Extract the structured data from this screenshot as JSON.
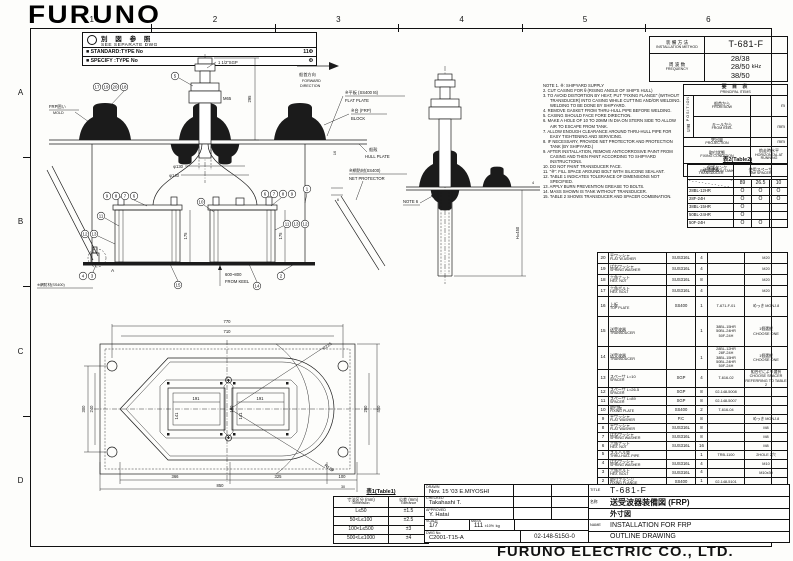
{
  "logo": "FURUNO",
  "company": "FURUNO ELECTRIC CO., LTD.",
  "grid": {
    "cols": [
      "1",
      "2",
      "3",
      "4",
      "5",
      "6"
    ],
    "rows": [
      "A",
      "B",
      "C",
      "D"
    ]
  },
  "ref_box": {
    "jp": "別 図 参 照",
    "en": "SEE SEPARATE DWG",
    "standard_label": "■ STANDARD:TYPE No",
    "standard_value": "11Φ",
    "specify_label": "■ SPECIFY :TYPE No",
    "specify_value": "Φ"
  },
  "method_table": {
    "method_jp": "装 備 方 法",
    "method_en": "INSTALLATION METHOD",
    "method_value": "T-681-F",
    "freq_jp": "周 波 数",
    "freq_en": "FREQUENCY",
    "freq_values": [
      "28/38",
      "28/50",
      "38/50"
    ],
    "freq_unit": "kHz"
  },
  "principal": {
    "title_jp": "要 目 表",
    "title_en": "PRINCIPAL ITEMS",
    "position_jp": "位置",
    "position_en": "POSITION",
    "row_bow_jp": "船首から",
    "row_bow_en": "FROM BOW",
    "row_bow_unit": "m",
    "row_keel_jp": "キールから",
    "row_keel_en": "FROM KEEL",
    "row_keel_unit": "mm",
    "row_proj_jp": "突出量",
    "row_proj_en": "PROJECTION",
    "row_proj_unit": "mm",
    "row_fix_jp": "取付状態",
    "row_fix_en": "FIXING CONDITION",
    "row_fix_val_jp": "航走時水平",
    "row_fix_val_en": "HORIZONTAL AT RUNNING",
    "row_tank_jp": "保護タンク",
    "row_tank_en": "PROTECTION TANK",
    "row_tank_val": ""
  },
  "table2": {
    "title": "表2(Table2)",
    "transducer_jp": "送受波器",
    "transducer_en": "TRANSDUCER",
    "spacer_jp": "使用スペーサ",
    "spacer_en": "Use SPACER",
    "spacer_cols": [
      "89",
      "26.5",
      "10"
    ],
    "rows": [
      {
        "model": "28BL-12HR",
        "marks": [
          "O",
          "O",
          "O"
        ]
      },
      {
        "model": "28F-24H",
        "marks": [
          "O",
          "O",
          "O"
        ]
      },
      {
        "model": "38BL-15HR",
        "marks": [
          "O",
          "",
          ""
        ]
      },
      {
        "model": "50BL-24HR",
        "marks": [
          "O",
          "",
          ""
        ]
      },
      {
        "model": "50F-24H",
        "marks": [
          "O",
          "O",
          ""
        ]
      }
    ]
  },
  "parts": {
    "header": {
      "no_jp": "番号",
      "name_jp": "名 称",
      "name_en": "NAME",
      "material_jp": "材 質",
      "material_en": "MATERIAL",
      "qty_jp": "数量",
      "qty_en": "Q'TY",
      "dwg_jp": "図 番",
      "dwg_en": "DWG.NO.",
      "remarks_jp": "摘 要",
      "remarks_en": "REMARKS"
    },
    "rows": [
      {
        "no": "20",
        "name_jp": "平ワッシャ",
        "name_en": "FLAT W ASHER",
        "material": "SUS316L",
        "qty": "4",
        "dwg": "",
        "remarks": "M20"
      },
      {
        "no": "19",
        "name_jp": "ばねワッシャ",
        "name_en": "SPRING WASHER",
        "material": "SUS316L",
        "qty": "4",
        "dwg": "",
        "remarks": "M20"
      },
      {
        "no": "18",
        "name_jp": "六角ナット",
        "name_en": "HEX. NUT",
        "material": "SUS316L",
        "qty": "8",
        "dwg": "",
        "remarks": "M20"
      },
      {
        "no": "17",
        "name_jp": "六角ボルト",
        "name_en": "HEX. BOLT",
        "material": "SUS316L",
        "qty": "4",
        "dwg": "",
        "remarks": "M20"
      },
      {
        "no": "16",
        "name_jp": "上板",
        "name_en": "TOP PLATE",
        "material": "SS400",
        "qty": "1",
        "dwg": "T-671-F-01",
        "remarks": "めっき MONJ.8"
      },
      {
        "no": "15",
        "name_jp": "送受波器",
        "name_en": "TRANSDUCER",
        "material": "",
        "qty": "1",
        "dwg": "38BL-15HR\n50BL-24HR\n50F-24H",
        "remarks": "1個選択\nCHOOSE ONE"
      },
      {
        "no": "14",
        "name_jp": "送受波器",
        "name_en": "TRANSDUCER",
        "material": "",
        "qty": "1",
        "dwg": "28BL-12HR\n28F-24H\n38BL-15HR\n50BL-24HR\n50F-24H",
        "remarks": "1個選択\nCHOOSE ONE"
      },
      {
        "no": "13",
        "name_jp": "スペーサ L=10",
        "name_en": "SPACER",
        "material": "SGP",
        "qty": "4",
        "dwg": "T-616-02",
        "remarks": "組合せにより選択\nCHOOSE SPACER\nREFERRING TO TABLE 2"
      },
      {
        "no": "12",
        "name_jp": "スペーサ L=26.5",
        "name_en": "SPACER",
        "material": "SGP",
        "qty": "8",
        "dwg": "02-148-5008",
        "remarks": ""
      },
      {
        "no": "11",
        "name_jp": "スペーサ L=89",
        "name_en": "SPACER",
        "material": "SGP",
        "qty": "8",
        "dwg": "02-148-5007",
        "remarks": ""
      },
      {
        "no": "10",
        "name_jp": "取付板",
        "name_en": "FIXING PLATE",
        "material": "SS400",
        "qty": "2",
        "dwg": "T-616-04",
        "remarks": ""
      },
      {
        "no": "9",
        "name_jp": "平ワッシャ",
        "name_en": "FLAT WASHER",
        "material": "P.C",
        "qty": "8",
        "dwg": "",
        "remarks": "めっき MONJ.8"
      },
      {
        "no": "8",
        "name_jp": "平ワッシャ",
        "name_en": "FLAT WASHER",
        "material": "SUS316L",
        "qty": "8",
        "dwg": "",
        "remarks": "M8"
      },
      {
        "no": "7",
        "name_jp": "ばねワッシャ",
        "name_en": "SPRING WASHER",
        "material": "SUS316L",
        "qty": "8",
        "dwg": "",
        "remarks": "M8"
      },
      {
        "no": "6",
        "name_jp": "六角ナット",
        "name_en": "HEX. NUT",
        "material": "SUS316L",
        "qty": "16",
        "dwg": "",
        "remarks": "M8"
      },
      {
        "no": "5",
        "name_jp": "スルハル管",
        "name_en": "THRU-HULL PIPE",
        "material": "",
        "qty": "1",
        "dwg": "TRB-1100",
        "remarks": "2HOLE 2穴"
      },
      {
        "no": "4",
        "name_jp": "ばねワッシャ",
        "name_en": "SPRING WASHER",
        "material": "SUS316L",
        "qty": "4",
        "dwg": "",
        "remarks": "M10"
      },
      {
        "no": "3",
        "name_jp": "六角ボルト",
        "name_en": "HEX. BOLT",
        "material": "SUS316L",
        "qty": "4",
        "dwg": "",
        "remarks": "M10x30"
      },
      {
        "no": "2",
        "name_jp": "取付フランジ",
        "name_en": "FIXING FLANGE",
        "material": "SS400",
        "qty": "1",
        "dwg": "02-148-5101",
        "remarks": ""
      },
      {
        "no": "1",
        "name_jp": "装備ケース",
        "name_en": "CASING",
        "material": "SS400",
        "qty": "1",
        "dwg": "T-671-01",
        "remarks": ""
      }
    ]
  },
  "notes": {
    "lines": [
      "NOTE 1. ※: SHIPYARD SUPPLY",
      "2. CUT CASING FOR θ (RISING ANGLE OF SHIP'S HULL)",
      "3. TO AVOID DISTORTION BY HEAT, PUT \"FIXING FLANGE\" (WITHOUT TRANSDUCER) INTO CASING WHILE CUTTING AND/OR WELDING. WELDING TO BE DONE BY SHIPYARD.",
      "4. REMOVE GASKET FROM THRU-HULL PIPE BEFORE WELDING.",
      "5. CASING SHOULD FACE FORE DIRECTION.",
      "6. MAKE A HOLE OF 10 TO 20MM IN DIA ON STERN SIDE TO ALLOW AIR TO ESCAPE FROM TANK.",
      "7. ALLOW ENOUGH CLEARANCE AROUND THRU-HULL PIPE FOR EASY TIGHTENING AND SERVICING.",
      "8. IF NECESSARY, PROVIDE NET PROTECTOR AND PROTECTION TANK (BY SHIPYARD.)",
      "9. AFTER INSTALLATION, REMOVE ANTICORROSIVE PAINT FROM CASING AND THEN PAINT ACCORDING TO SHIPYARD INSTRUCTIONS.",
      "10. DO NOT PAINT TRANSDUCER FACE.",
      "11. \"※\": FILL SPACE AROUND BOLT WITH SILICONE SEALANT.",
      "12. TABLE 1 INDICATES TOLERANCE OF DIMENSIONS NOT SPECIFIED.",
      "13. APPLY BURN PREVENTION GREASE TO BOLTS.",
      "14. MASS SHOWN IS TANK WITHOUT TRANSDUCER.",
      "15. TABLE 2 SHOWS TRANSDUCER AND SPACER COMBINATION."
    ]
  },
  "table1": {
    "title": "表1(Table1)",
    "col1_jp": "寸法区分 (mm)",
    "col1_en": "Dimension",
    "col2_jp": "公差 (mm)",
    "col2_en": "Tolerance",
    "rows": [
      [
        "L≤50",
        "±1.5"
      ],
      [
        "50<L≤100",
        "±2.5"
      ],
      [
        "100<L≤500",
        "±3"
      ],
      [
        "500<L≤1000",
        "±4"
      ]
    ]
  },
  "titleblock": {
    "drawn_label": "DRAWN",
    "drawn_date": "Nov. 15 '03",
    "drawn_name": "E.MIYOSHI",
    "checked_label": "CHECKED",
    "checked_name": "Takahashi T.",
    "approved_label": "APPROVED",
    "approved_name": "Y. Hatai",
    "scale_label": "SCALE",
    "scale_value": "1/7",
    "mass_label": "MASS",
    "mass_value": "111",
    "mass_tol": "±10%",
    "mass_unit": "kg",
    "dwgno_label": "DWG No.",
    "dwgno_value": "C2001-T15-A",
    "code": "02-148-515G-0",
    "title_label": "TITLE",
    "title_value": "T-681-F",
    "name_jp_label": "名称",
    "name_jp_1": "送受波器装備図 (FRP)",
    "name_jp_2": "外寸図",
    "name_en_label": "NAME",
    "name_en_1": "INSTALLATION FOR FRP",
    "name_en_2": "OUTLINE DRAWING"
  },
  "front_view": {
    "pipe_size": "1 1/2\"SGP",
    "dim_height": "295",
    "thread": "M65",
    "dia1": "φ130",
    "dia2": "φ140",
    "plate_t": "16",
    "gap": "6",
    "tank_h1": "175",
    "tank_h2": "175",
    "mold_jp": "FRP囲い",
    "mold_en": "MOLD",
    "forward_jp": "船首方向",
    "forward_en1": "FORWARD",
    "forward_en2": "DIRECTION",
    "flat_plate_jp": "※平板 (SS400 t6)",
    "flat_plate_en": "FLAT PLATE",
    "block_jp": "※台 (FRP)",
    "block_en": "BLOCK",
    "hull_jp": "船殻",
    "hull_en": "HULL PLATE",
    "net_jp": "※網防材(SS400)",
    "net_en": "NET PROTECTOR",
    "net2_jp": "※網防材(SS400)",
    "from_keel_1": "600~800",
    "from_keel_2": "FROM KEEL",
    "detail_label": "A",
    "callouts": {
      "g1": [
        "17",
        "19",
        "20",
        "18"
      ],
      "c5": "5",
      "g2": [
        "9",
        "8",
        "7",
        "6"
      ],
      "c11": "11",
      "g3": [
        "12",
        "13"
      ],
      "c10": "10",
      "g4": [
        "6",
        "7",
        "8",
        "9"
      ],
      "c1": "1",
      "g5": [
        "11",
        "13",
        "12"
      ],
      "g6": [
        "4",
        "3"
      ],
      "c15": "15",
      "c14": "14",
      "c2": "2"
    }
  },
  "side_view": {
    "note": "NOTE 6",
    "dim_h": "H=450",
    "dim_t": "4"
  },
  "plan_view": {
    "d770": "770",
    "d710": "710",
    "d300": "300",
    "d240": "240",
    "d450": "450",
    "d250": "250",
    "d191a": "191",
    "d191b": "191",
    "d141a": "141",
    "d141b": "141",
    "d180": "180",
    "r225": "R225",
    "r125": "R125",
    "d366": "366",
    "d325": "325",
    "d100": "100",
    "d10": "10",
    "d30": "30",
    "d850": "850"
  }
}
